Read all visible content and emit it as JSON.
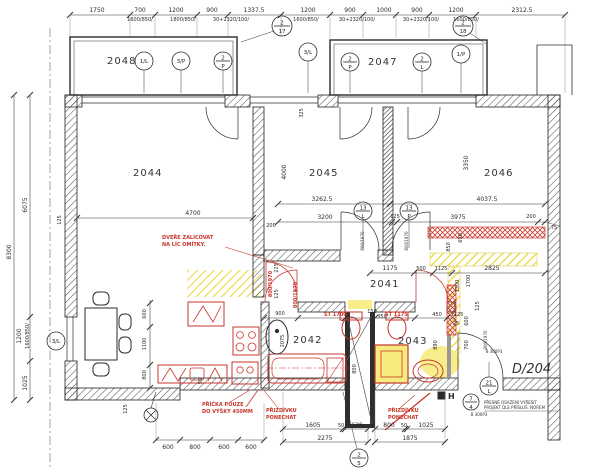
{
  "colors": {
    "red": "#c9342b",
    "yellow": "#f1e23a",
    "ink": "#2b2b2b"
  },
  "rooms": [
    "2048",
    "2047",
    "2044",
    "2045",
    "2046",
    "2041",
    "2042",
    "2043"
  ],
  "t1": [
    "1750",
    "700",
    "1200",
    "900",
    "1337.5",
    "1200",
    "900",
    "1000",
    "900",
    "1200",
    "2312.5"
  ],
  "t2": [
    "1600/850/",
    "1800/850/",
    "30+2320/100/",
    "1600/850/",
    "30+2320/100/",
    "30+2320/100/",
    "1600/850/"
  ],
  "lv": [
    "8300",
    "6075",
    "1200",
    "1600/850/",
    "1025",
    "125",
    "125",
    "50"
  ],
  "iv": [
    "4700",
    "200",
    "3262.5",
    "4037.5",
    "3200",
    "125",
    "3975",
    "200",
    "75",
    "4000",
    "3350",
    "325",
    "1175",
    "500",
    "1125",
    "2825",
    "850",
    "650",
    "1300",
    "1700",
    "125",
    "600",
    "700",
    "450",
    "1125",
    "25",
    "900",
    "150",
    "350",
    "125",
    "225",
    "2075",
    "890",
    "800",
    "600",
    "1100",
    "800"
  ],
  "dl": [
    "800/1970",
    "800/1970",
    "800/1970",
    "B 300P3",
    "B 300P3"
  ],
  "bt": [
    "600",
    "800",
    "600",
    "600",
    "1605",
    "50",
    "620",
    "2275",
    "800",
    "50",
    "1025",
    "1875"
  ],
  "rn": [
    "DVEŘE ZALICOVAT",
    "NA LÍC OMÍTKY.",
    "PŘÍČKA POUZE",
    "DO VÝŠKY 450MM",
    "PŘIZDÍVKU",
    "PONECHAT",
    "PŘIZDÍVKU",
    "PONECHAT",
    "ST 1700",
    "ST 1175",
    "800/1970",
    "800/1970"
  ],
  "nt": [
    "PŘESNÉ OSAZENÍ VYŘEŠIT",
    "PROJEKT DLE PŘÍSLUŠ. NOREM"
  ],
  "circles": [
    {
      "text": "1/L"
    },
    {
      "text": "3/P"
    },
    {
      "top": "2",
      "bot": "P"
    },
    {
      "top": "2",
      "bot": "17"
    },
    {
      "text": "3/L"
    },
    {
      "top": "2",
      "bot": "P"
    },
    {
      "top": "2",
      "bot": "L"
    },
    {
      "text": "1/P"
    },
    {
      "top": "2",
      "bot": "18"
    },
    {
      "top": "13",
      "bot": "L"
    },
    {
      "top": "13",
      "bot": "P"
    },
    {
      "text": "3/L"
    },
    {
      "top": "21",
      "bot": "L"
    },
    {
      "top": "7",
      "bot": "4"
    },
    {
      "top": "2",
      "bot": "5"
    }
  ],
  "refs": {
    "d204": "D/204",
    "h": "H"
  }
}
